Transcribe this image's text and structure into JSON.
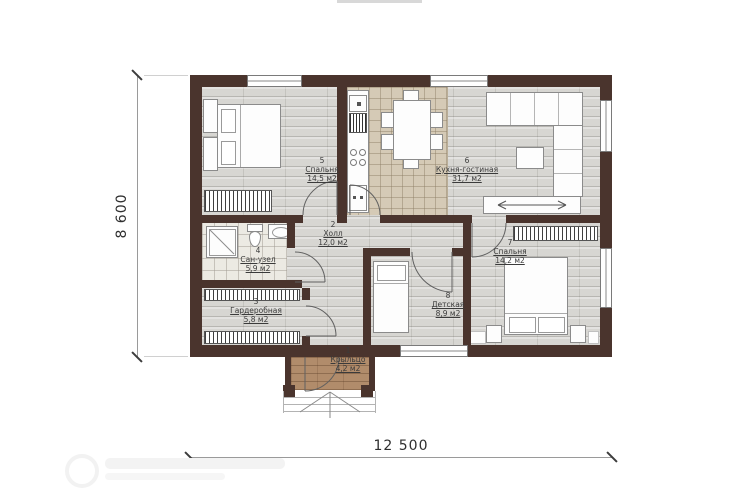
{
  "plan": {
    "dim_width_label": "12 500",
    "dim_height_label": "8 600",
    "rooms": [
      {
        "number": "1",
        "name": "Крыльцо",
        "area": "4,2 м2"
      },
      {
        "number": "2",
        "name": "Холл",
        "area": "12,0 м2"
      },
      {
        "number": "3",
        "name": "Гардеробная",
        "area": "5,8 м2"
      },
      {
        "number": "4",
        "name": "Сан-узел",
        "area": "5,9 м2"
      },
      {
        "number": "5",
        "name": "Спальня",
        "area": "14,5 м2"
      },
      {
        "number": "6",
        "name": "Кухня-гостиная",
        "area": "31,7 м2"
      },
      {
        "number": "7",
        "name": "Спальня",
        "area": "14,2 м2"
      },
      {
        "number": "8",
        "name": "Детская",
        "area": "8,9 м2"
      }
    ],
    "colors": {
      "wall": "#4a342d",
      "wood_floor": "#d7d6d2",
      "tile_floor": "#d5cab6",
      "bath_floor": "#eceae3",
      "porch_floor": "#b18c6b"
    }
  }
}
